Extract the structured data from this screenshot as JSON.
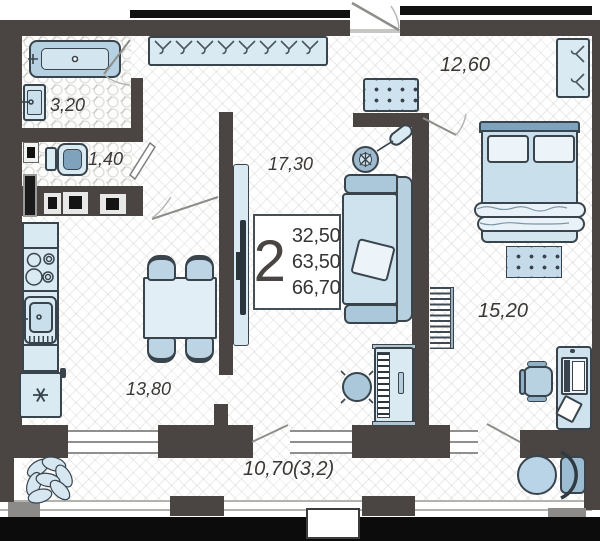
{
  "plan": {
    "unit": {
      "rooms_count": "2",
      "areas": [
        "32,50",
        "63,50",
        "66,70"
      ]
    },
    "rooms": {
      "bathroom": {
        "area": "3,20"
      },
      "toilet": {
        "area": "1,40"
      },
      "living_room": {
        "area": "17,30"
      },
      "hallway": {
        "area": "12,60"
      },
      "bedroom": {
        "area": "15,20"
      },
      "kitchen_dining": {
        "area": "13,80"
      },
      "balcony": {
        "area": "10,70(3,2)"
      }
    },
    "colors": {
      "wall": "#4a4543",
      "outer_structure": "#0d0d0d",
      "furniture_fill": "#d9eaf3",
      "furniture_accent": "#7fa3bc",
      "outline": "#39444c",
      "label_text": "#3b3735"
    },
    "icons": {
      "hanger-icon": "clothes hanger (V with hook)",
      "snowflake-icon": "fridge snowflake asterisk",
      "plant-icon": "leaf cluster plant",
      "burner-icon": "stove burner rings"
    }
  }
}
